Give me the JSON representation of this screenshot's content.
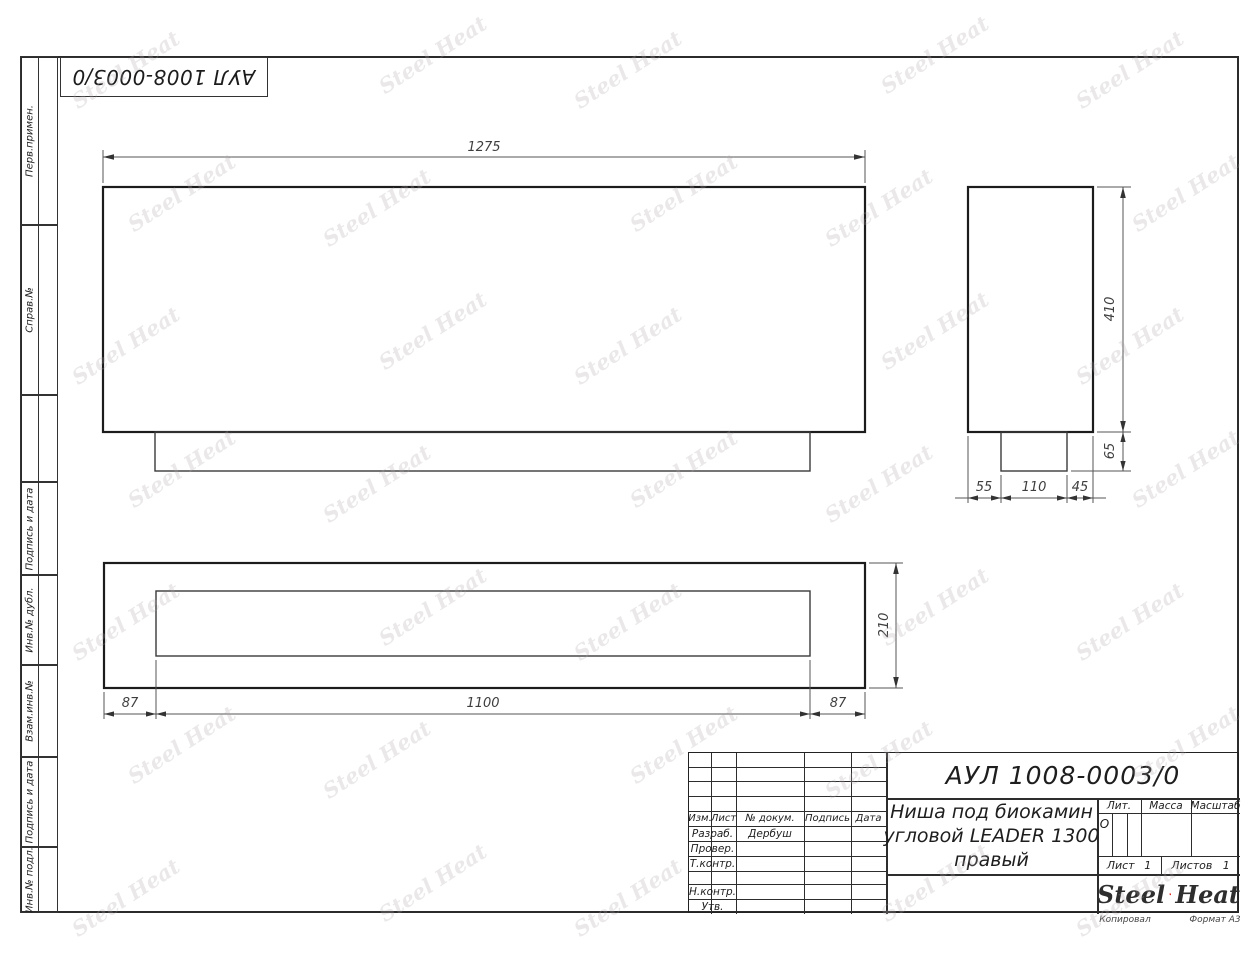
{
  "corner_stamp": {
    "designation": "АУЛ 1008-0003/0"
  },
  "margin_labels": [
    "Перв.примен.",
    "Справ.№",
    "Подпись и дата",
    "Инв.№ дубл.",
    "Взам.инв.№",
    "Подпись и дата",
    "Инв.№ подл."
  ],
  "watermark": {
    "text": "Steel Heat"
  },
  "drawing": {
    "dims": {
      "front_width": "1275",
      "side_height": "410",
      "side_plinth_height": "65",
      "side_front_offset": "55",
      "side_plinth_depth": "110",
      "side_back_offset": "45",
      "plan_margin_left": "87",
      "plan_opening": "1100",
      "plan_margin_right": "87",
      "plan_depth": "210"
    }
  },
  "title_block": {
    "designation": "АУЛ 1008-0003/0",
    "name_lines": [
      "Ниша под биокамин",
      "угловой LEADER 1300",
      "правый"
    ],
    "header": {
      "izm": "Изм.",
      "list": "Лист",
      "doc": "№ докум.",
      "sign": "Подпись",
      "date": "Дата"
    },
    "roles": {
      "razrab": "Разраб.",
      "prover": "Провер.",
      "tkontr": "Т.контр.",
      "nkontr": "Н.контр.",
      "utv": "Утв."
    },
    "razrab_name": "Дербуш",
    "lit": {
      "label": "Лит.",
      "value": "О"
    },
    "massa_label": "Масса",
    "masshtab_label": "Масштаб",
    "sheet": {
      "label": "Лист",
      "value": "1"
    },
    "sheets": {
      "label": "Листов",
      "value": "1"
    },
    "logo": {
      "word1": "Steel",
      "word2": "Heat"
    }
  },
  "footer": {
    "copied": "Копировал",
    "format": "Формат А3"
  }
}
